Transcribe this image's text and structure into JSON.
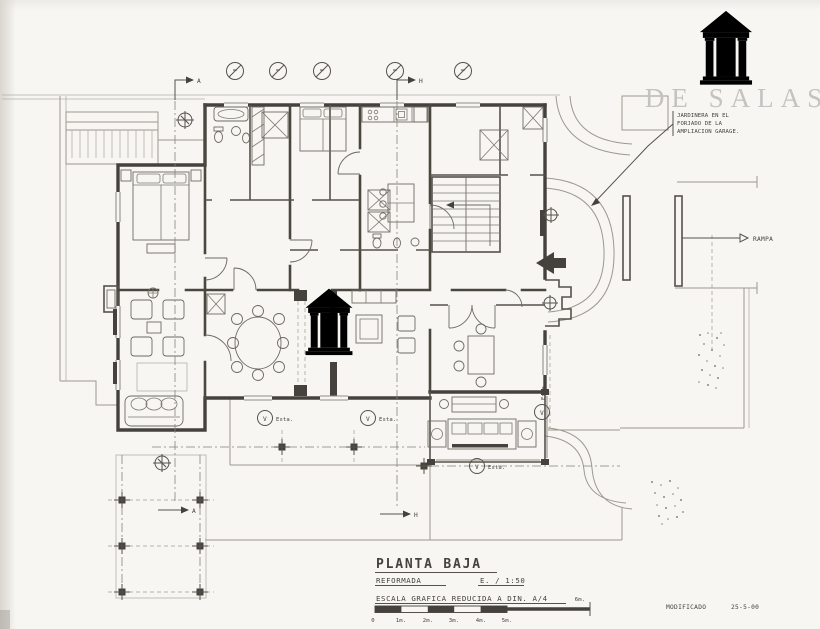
{
  "brand": {
    "name": "DE SALAS",
    "logo_gray": "#c6c4c1",
    "logo_teal": "#2f7e90"
  },
  "title_block": {
    "title": "PLANTA BAJA",
    "subtitle": "REFORMADA",
    "scale": "E. / 1:50",
    "scale_note": "ESCALA GRAFICA REDUCIDA A DIN. A/4",
    "modified_label": "MODIFICADO",
    "modified_date": "25-5-00"
  },
  "scale_bar": {
    "labels": [
      "0",
      "1m.",
      "2m.",
      "3m.",
      "4m.",
      "5m."
    ],
    "end_label": "6m."
  },
  "annotations": {
    "jardinera": [
      "JARDINERA EN EL",
      "FORJADO DE LA",
      "AMPLIACION GARAGE."
    ],
    "rampa": "RAMPA",
    "esta_label": "Esta.",
    "marker_v": "V",
    "section_a": "A",
    "section_h": "H"
  }
}
